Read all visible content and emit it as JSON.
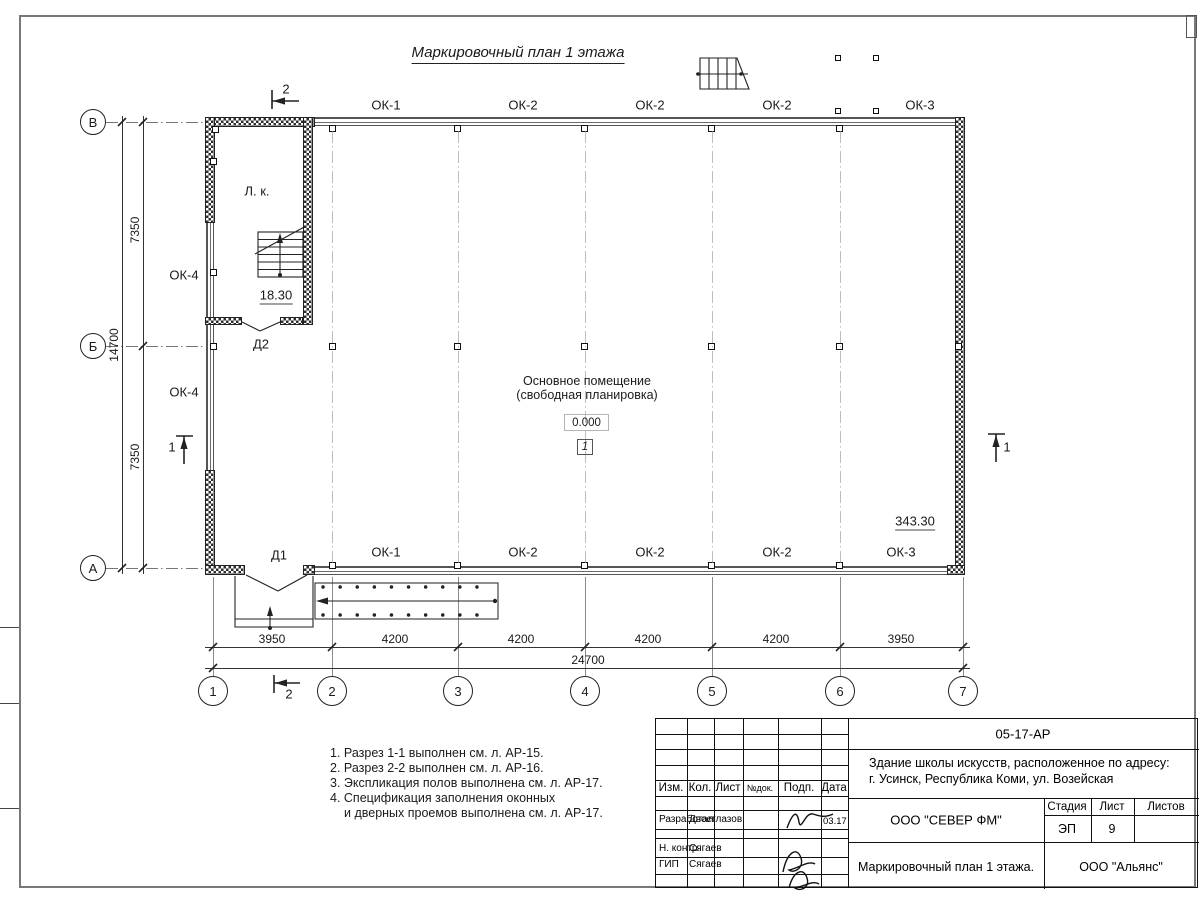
{
  "colors": {
    "paper": "#ffffff",
    "line": "#2a2a2a",
    "frame": "#787878"
  },
  "sheet": {
    "title": "Маркировочный план 1 этажа"
  },
  "plan": {
    "windows_top": [
      "ОК-1",
      "ОК-2",
      "ОК-2",
      "ОК-2",
      "ОК-3"
    ],
    "windows_bottom": [
      "ОК-1",
      "ОК-2",
      "ОК-2",
      "ОК-2",
      "ОК-3"
    ],
    "windows_left": [
      "ОК-4",
      "ОК-4"
    ],
    "doors": {
      "d1": "Д1",
      "d2": "Д2"
    },
    "stairwell_label": "Л. к.",
    "stairwell_area": "18.30",
    "main_room_line1": "Основное помещение",
    "main_room_line2": "(свободная планировка)",
    "main_room_area": "343.30",
    "elevation": "0.000",
    "room_number": "1",
    "section_1": "1",
    "section_2": "2",
    "axis_letters": [
      "В",
      "Б",
      "А"
    ],
    "axis_numbers": [
      "1",
      "2",
      "3",
      "4",
      "5",
      "6",
      "7"
    ],
    "dim_left_top": "7350",
    "dim_left_total": "14700",
    "dim_left_bottom": "7350",
    "dims_bottom": [
      "3950",
      "4200",
      "4200",
      "4200",
      "4200",
      "3950"
    ],
    "dim_bottom_total": "24700"
  },
  "notes": {
    "lines": [
      "1. Разрез 1-1 выполнен см. л. АР-15.",
      "2. Разрез 2-2 выполнен см. л. АР-16.",
      "3. Экспликация полов выполнена см. л. АР-17.",
      "4. Спецификация заполнения оконных",
      "и дверных проемов выполнена см. л. АР-17."
    ]
  },
  "title_block": {
    "doc_code": "05-17-АР",
    "project_line1": "Здание школы искусств, расположенное по адресу:",
    "project_line2": "г. Усинск, Республика Коми, ул. Возейская",
    "cols": [
      "Изм.",
      "Кол.",
      "Лист",
      "№док.",
      "Подп.",
      "Дата"
    ],
    "row_developed_label": "Разработал",
    "row_developed_name": "Двоеглазов",
    "row_developed_date": "03.17",
    "row_ncontr_label": "Н. контр.",
    "row_ncontr_name": "Сягаев",
    "row_gip_label": "ГИП",
    "row_gip_name": "Сягаев",
    "company": "ООО \"СЕВЕР ФМ\"",
    "stage_label": "Стадия",
    "sheet_label": "Лист",
    "sheets_label": "Листов",
    "stage_value": "ЭП",
    "sheet_value": "9",
    "drawing_title": "Маркировочный план 1 этажа.",
    "firm": "ООО \"Альянс\""
  }
}
